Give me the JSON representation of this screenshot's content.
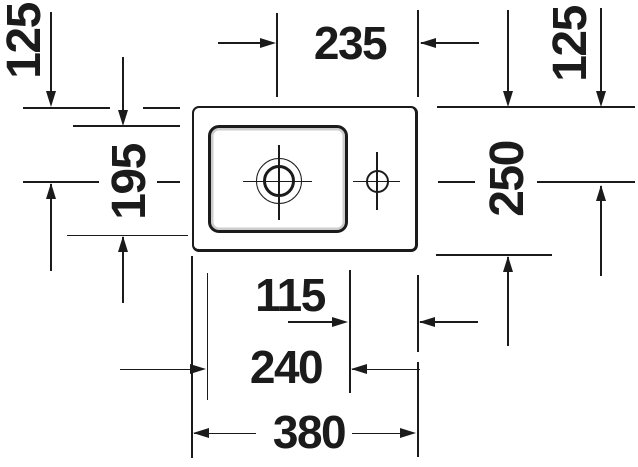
{
  "colors": {
    "ink": "#1b1b1b",
    "background": "#ffffff"
  },
  "dimensions": {
    "top_left_125": "125",
    "top_235": "235",
    "top_right_125": "125",
    "left_195": "195",
    "right_250": "250",
    "bottom_115": "115",
    "bottom_240": "240",
    "bottom_380": "380"
  }
}
